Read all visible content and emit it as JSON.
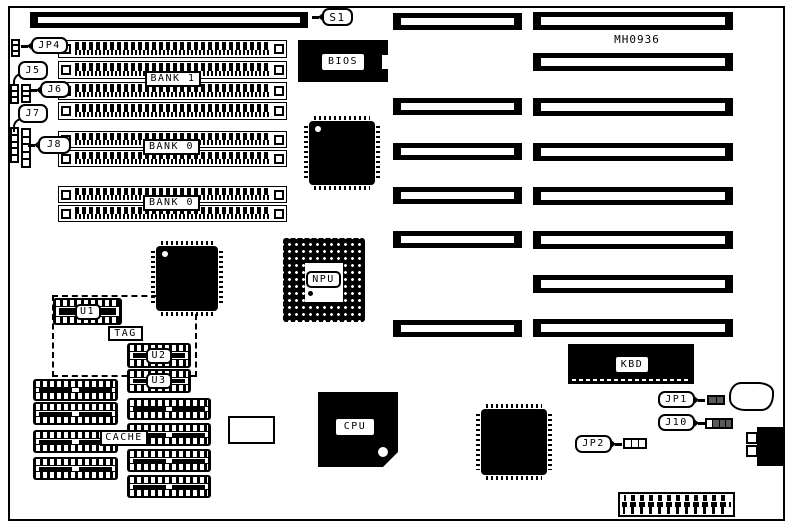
{
  "diagram": {
    "type": "motherboard-layout",
    "part_number": "MH0936"
  },
  "callouts": {
    "s1": "S1",
    "jp4": "JP4",
    "j5": "J5",
    "j6": "J6",
    "j7": "J7",
    "j8": "J8",
    "jp1": "JP1",
    "j10": "J10",
    "jp2": "JP2"
  },
  "chips": {
    "bios": "BIOS",
    "npu": "NPU",
    "cpu": "CPU",
    "kbd": "KBD"
  },
  "memory": {
    "bank1": "BANK 1",
    "bank0_upper": "BANK 0",
    "bank0_lower": "BANK 0"
  },
  "cache": {
    "cache": "CACHE",
    "tag": "TAG",
    "u1": "U1",
    "u2": "U2",
    "u3": "U3"
  },
  "colors": {
    "ink": "#000000",
    "paper": "#ffffff"
  }
}
